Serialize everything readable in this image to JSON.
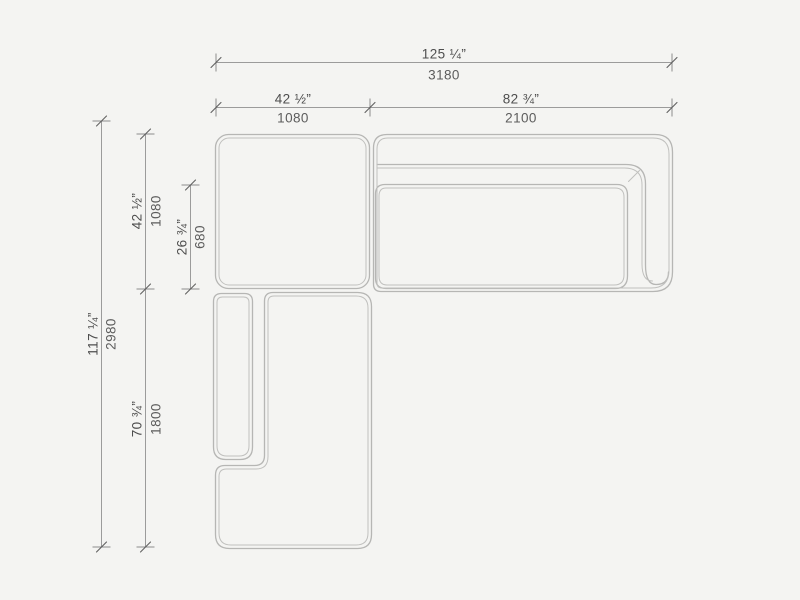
{
  "dimensions": {
    "overall_width": {
      "inches": "125 ¼”",
      "mm": "3180"
    },
    "left_section_width": {
      "inches": "42 ½”",
      "mm": "1080"
    },
    "right_section_width": {
      "inches": "82 ¾”",
      "mm": "2100"
    },
    "overall_depth": {
      "inches": "117 ¼”",
      "mm": "2980"
    },
    "corner_section_depth": {
      "inches": "42 ½”",
      "mm": "1080"
    },
    "seat_depth": {
      "inches": "26 ¾”",
      "mm": "680"
    },
    "chaise_length": {
      "inches": "70 ¾”",
      "mm": "1800"
    }
  },
  "colors": {
    "background": "#f4f4f2",
    "furniture_outline": "#b6b6b4",
    "furniture_inner_line": "#c0c0be",
    "dimension_line": "#9b9b9b",
    "tick_mark": "#606060",
    "label_text": "#4e4e4e"
  }
}
